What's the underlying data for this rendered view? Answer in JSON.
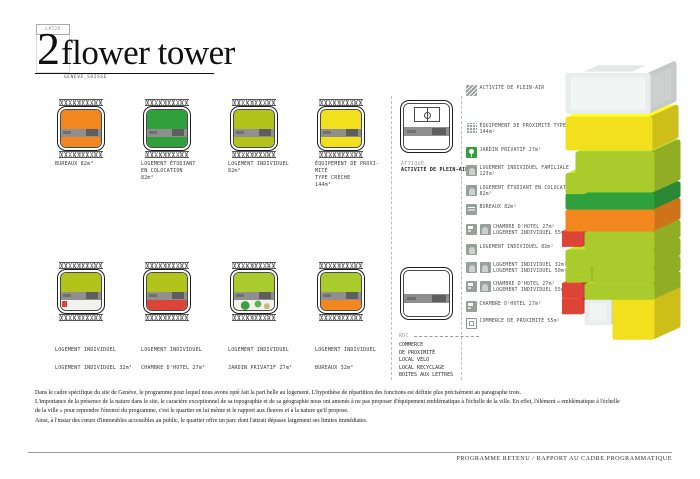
{
  "palette": {
    "orange": "#F2871F",
    "green": "#2FA03C",
    "olive": "#B2C41C",
    "chartreuse": "#A9CB2B",
    "yellow": "#F2DF1D",
    "red": "#DD4438",
    "core_gray": "#8F8F8F",
    "icon_gray": "#98A09C",
    "tower_white": "#F2F5F4",
    "garden_bg": "#F2F2EC"
  },
  "header": {
    "code": "L#725",
    "title_number": "2",
    "title_text": "flower tower",
    "subtitle": "GENÈVE_SUISSE"
  },
  "plans": {
    "row1": [
      {
        "lines": [
          "BUREAUX  82m²"
        ],
        "colors": {
          "top": "#F2871F",
          "bottom": "#F2871F"
        }
      },
      {
        "lines": [
          "LOGEMENT ÉTUDIANT",
          "EN COLOCATION",
          "82m²"
        ],
        "colors": {
          "top": "#2FA03C",
          "bottom": "#2FA03C"
        }
      },
      {
        "lines": [
          "LOGEMENT  INDIVIDUEL",
          "82m²"
        ],
        "colors": {
          "top": "#B2C41C",
          "bottom": "#B2C41C"
        }
      },
      {
        "lines": [
          "ÉQUIPEMENT  DE  PROXI-",
          "MITÉ",
          "TYPE  CRECHE",
          "144m²"
        ],
        "colors": {
          "top": "#F2DF1D",
          "bottom": "#F2DF1D"
        }
      }
    ],
    "row2": [
      {
        "lines": [
          "LOGEMENT  INDIVIDUEL",
          "LOGEMENT INDIVIDUEL 32m²"
        ],
        "colors": {
          "top": "#B2C41C",
          "bottom": "#F2F2EC"
        }
      },
      {
        "lines": [
          "LOGEMENT  INDIVIDUEL",
          "CHAMBRE D'HOTEL 27m²"
        ],
        "colors": {
          "top": "#B2C41C",
          "bottom": "#DD4438"
        }
      },
      {
        "lines": [
          "LOGEMENT  INDIVIDUEL",
          "JARDIN PRIVATIF 27m²"
        ],
        "colors": {
          "top": "#A9CB2B",
          "bottom": "#F2F2EC"
        }
      },
      {
        "lines": [
          "LOGEMENT  INDIVIDUEL",
          "BUREAUX 32m²"
        ],
        "colors": {
          "top": "#A9CB2B",
          "bottom": "#F2871F"
        }
      }
    ]
  },
  "middle": {
    "attique": {
      "tag": "ATTIQUE",
      "label": "ACTIVITÉ DE PLEIN-AIR"
    },
    "rdc": {
      "tag": "RDC",
      "lines": [
        "COMMERCE",
        "DE PROXIMITÉ",
        "LOCAL VÉLO",
        "LOCAL RECYCLAGE",
        "BOITES AUX LETTRES"
      ]
    }
  },
  "legend": {
    "items": [
      {
        "lines": [
          "ACTIVITÉ DE PLEIN-AIR"
        ]
      },
      {
        "lines": [
          "ÉQUIPEMENT DE PROXIMITÉ TYPE CRECHE",
          "144m²"
        ]
      },
      {
        "lines": [
          "JARDIN PRIVATIF  27m²"
        ]
      },
      {
        "lines": [
          "LOGEMENT INDIVIDUEL FAMILIALE",
          "123m²"
        ]
      },
      {
        "lines": [
          "LOGEMENT ÉTUDIANT EN COLOCATION",
          "82m²"
        ]
      },
      {
        "lines": [
          "BUREAUX  82m²"
        ]
      },
      {
        "lines": [
          "CHAMBRE D'HOTEL  27m²",
          "LOGEMENT INDIVIDUEL  55m²"
        ]
      },
      {
        "lines": [
          "LOGEMENT  INDIVIDUEL  82m²"
        ]
      },
      {
        "lines": [
          "LOGEMENT INDIVIDUEL  32m²",
          "LOGEMENT INDIVIDUEL  50m²"
        ]
      },
      {
        "lines": [
          "CHAMBRE D'HOTEL  27m²",
          "LOGEMENT INDIVIDUEL  55m²"
        ]
      },
      {
        "lines": [
          "CHAMBRE D'HOTEL  27m²"
        ]
      },
      {
        "lines": [
          "COMMERCE  DE  PROXIMITÉ  55m²"
        ]
      }
    ]
  },
  "tower": {
    "levels_top_to_bottom": [
      [
        "white"
      ],
      [
        "yellow"
      ],
      [
        "chartreuse"
      ],
      [
        "green"
      ],
      [
        "orange"
      ],
      [
        "red",
        "chartreuse"
      ],
      [
        "chartreuse"
      ],
      [
        "chartreuse",
        "chartreuse"
      ],
      [
        "red",
        "chartreuse"
      ],
      [
        "red",
        "white",
        "yellow"
      ]
    ]
  },
  "paragraph": {
    "lines": [
      "Dans le cadre spécifique du site de Genève, le programme pour lequel nous avons opté fait la part belle au logement. L'hypothèse de répartition  des fonctions est définie plus précisément au paragraphe trois.",
      "L'importance de la présence de la nature dans le site, le caractère exceptionnel de sa topographie et de sa géographie nous ont amenés à ne pas proposer d'équipement emblématique à l'échelle de la ville. En effet, l'élément « emblématique  à l'échelle",
      "de la ville » pour reprendre l'énoncé du programme, c'est le quartier en lui même et le rapport  aux fleuves et à la nature qu'il propose.",
      "Ainsi, à l'instar des cœurs d'immeubles accessibles au public, le quartier offre un parc dont l'attrait dépasse largement ses limites immédiates."
    ]
  },
  "footer": {
    "text": "PROGRAMME RETENU / RAPPORT AU  CADRE PROGRAMMATIQUE"
  }
}
